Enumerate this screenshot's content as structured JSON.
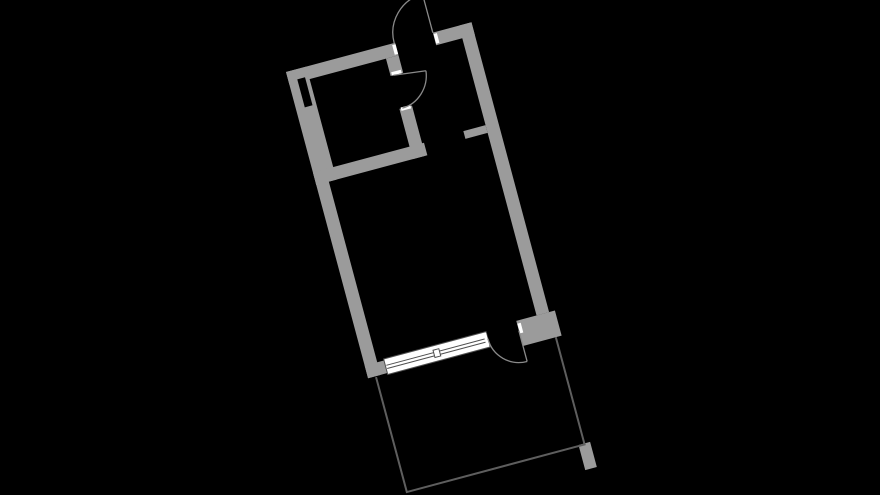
{
  "canvas": {
    "width": 880,
    "height": 495,
    "background": "#000000"
  },
  "floorplan": {
    "origin": {
      "x": 286,
      "y": 72
    },
    "rotation_deg": -15,
    "colors": {
      "wall": "#9b9b9b",
      "duct": "#000000",
      "door_line": "#8a8a8a",
      "balcony_line": "#5e5e5e",
      "window_line": "#4f4f4f",
      "window_fill": "#ffffff",
      "jamb_marker": "#ffffff"
    },
    "walls": [
      {
        "name": "top-wall-bathroom",
        "x": 0,
        "y": 0,
        "w": 113,
        "h": 13
      },
      {
        "name": "top-wall-entry-right",
        "x": 152,
        "y": 0,
        "w": 40,
        "h": 13
      },
      {
        "name": "right-wall",
        "x": 179,
        "y": 0,
        "w": 13,
        "h": 300
      },
      {
        "name": "left-wall-bathroom",
        "x": 0,
        "y": 0,
        "w": 21,
        "h": 117
      },
      {
        "name": "left-wall-lower",
        "x": 0,
        "y": 115,
        "w": 13,
        "h": 202
      },
      {
        "name": "bottom-corner-block",
        "x": 0,
        "y": 304,
        "w": 20,
        "h": 13
      },
      {
        "name": "bathroom-bottom-wall",
        "x": 0,
        "y": 104,
        "w": 115,
        "h": 13
      },
      {
        "name": "bathroom-right-wall-upper",
        "x": 100,
        "y": 13,
        "w": 13,
        "h": 18
      },
      {
        "name": "bathroom-right-wall-lower",
        "x": 100,
        "y": 65,
        "w": 13,
        "h": 52
      },
      {
        "name": "hall-stub-wall",
        "x": 156,
        "y": 103,
        "w": 23,
        "h": 8
      },
      {
        "name": "balcony-door-pier",
        "x": 158,
        "y": 300,
        "w": 40,
        "h": 26
      },
      {
        "name": "balcony-pillar",
        "x": 186,
        "y": 436,
        "w": 12,
        "h": 26
      }
    ],
    "duct_slot": {
      "name": "duct-slot",
      "x": 9,
      "y": 10,
      "w": 8,
      "h": 29
    },
    "jamb_markers": [
      {
        "name": "entrance-jamb-left",
        "x": 109.5,
        "y": 1.5,
        "w": 3.5,
        "h": 10
      },
      {
        "name": "entrance-jamb-right",
        "x": 152.3,
        "y": 1.5,
        "w": 3.5,
        "h": 10
      },
      {
        "name": "bathroom-door-jamb-top",
        "x": 101.5,
        "y": 27.5,
        "w": 10,
        "h": 3.5
      },
      {
        "name": "bathroom-door-jamb-bottom",
        "x": 101.5,
        "y": 64,
        "w": 10,
        "h": 3.5
      },
      {
        "name": "balcony-door-jamb-left",
        "x": 122.8,
        "y": 303.5,
        "w": 3,
        "h": 13
      },
      {
        "name": "balcony-door-jamb-right",
        "x": 158.3,
        "y": 303,
        "w": 3.5,
        "h": 10
      }
    ],
    "doors": [
      {
        "name": "entrance-door",
        "leaf": {
          "x1": 152,
          "y1": 0,
          "x2": 152,
          "y2": -40
        },
        "arc": "M112,0 C112,-22.1 129.9,-40 152,-40"
      },
      {
        "name": "bathroom-door",
        "leaf": {
          "x1": 103,
          "y1": 31,
          "x2": 135.5,
          "y2": 35
        },
        "arc": "M135.5,35 C133.5,51.5 119.6,65 103,65"
      },
      {
        "name": "balcony-door",
        "leaf": {
          "x1": 158,
          "y1": 310,
          "x2": 158,
          "y2": 342
        },
        "arc": "M126,310 C126,327.7 140.3,342 158,342"
      }
    ],
    "window": {
      "frame": {
        "x": 20,
        "y": 302.5,
        "w": 106,
        "h": 16
      },
      "glazing_lines": [
        {
          "x1": 21,
          "y1": 309.3,
          "x2": 125,
          "y2": 309.3
        },
        {
          "x1": 21,
          "y1": 312.6,
          "x2": 125,
          "y2": 312.6
        }
      ],
      "mullion": {
        "x": 70,
        "y": 306.8,
        "w": 6,
        "h": 7.5
      }
    },
    "balcony": {
      "name": "balcony-railing",
      "path": "M8,318 L8,437 L192,437 L192,326",
      "stroke_width": 2
    }
  }
}
